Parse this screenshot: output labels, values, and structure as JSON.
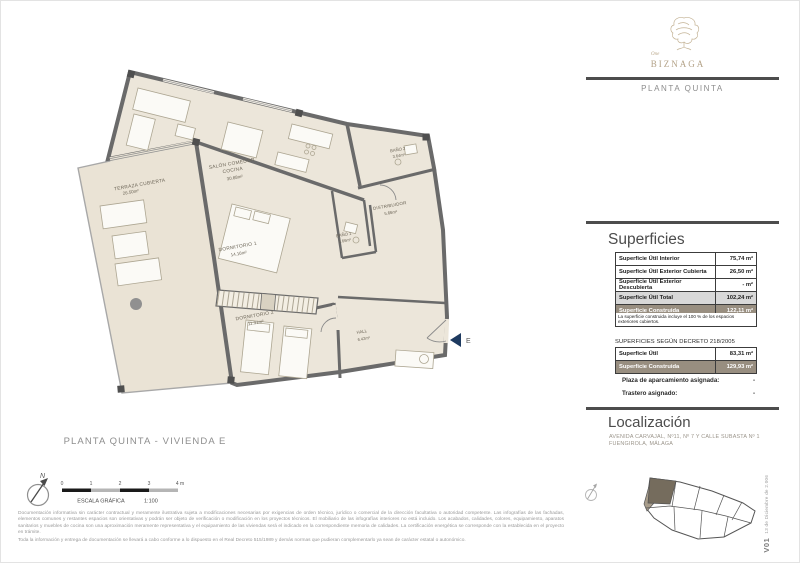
{
  "brand": {
    "word": "One",
    "name": "BIZNAGA",
    "floor": "PLANTA QUINTA"
  },
  "plan": {
    "title": "PLANTA QUINTA - VIVIENDA E",
    "entrance": "E",
    "north": "N",
    "rooms": {
      "terraza": {
        "name": "TERRAZA CUBIERTA",
        "area": "26.50m²"
      },
      "salon": {
        "name1": "SALÓN COMEDOR",
        "name2": "COCINA",
        "area": "30.88m²"
      },
      "dorm1": {
        "name": "DORMITORIO 1",
        "area": "14.16m²"
      },
      "dorm2": {
        "name": "DORMITORIO 2",
        "area": "11.31m²"
      },
      "bano1": {
        "name": "BAÑO 1",
        "area": "3.66m²"
      },
      "bano2": {
        "name": "BAÑO 2",
        "area": "3.64m²"
      },
      "distribuidor": {
        "name": "DISTRIBUIDOR",
        "area": "5.66m²"
      },
      "hall": {
        "name": "HALL",
        "area": "6.42m²"
      }
    },
    "scale": {
      "ticks": [
        "0",
        "1",
        "2",
        "3",
        "4 m"
      ],
      "caption": "ESCALA GRÁFICA",
      "ratio": "1:100"
    }
  },
  "sup": {
    "heading": "Superficies",
    "rows": [
      {
        "label": "Superficie Útil Interior",
        "value": "75,74 m²"
      },
      {
        "label": "Superficie Útil Exterior Cubierta",
        "value": "26,50 m²"
      },
      {
        "label": "Superficie Útil Exterior Descubierta",
        "value": "- m²"
      },
      {
        "label": "Superficie Útil Total",
        "value": "102,24 m²"
      },
      {
        "label": "Superficie Construida",
        "value": "122,11 m²"
      }
    ],
    "note": "La superficie construida incluye el 100 % de los espacios exteriores cubiertos."
  },
  "dec": {
    "title": "SUPERFICIES SEGÚN DECRETO 218/2005",
    "rows": [
      {
        "label": "Superficie Útil",
        "value": "83,31 m²"
      },
      {
        "label": "Superficie Construida",
        "value": "129,93 m²"
      }
    ],
    "extras": [
      {
        "label": "Plaza de aparcamiento asignada:",
        "value": "-"
      },
      {
        "label": "Trastero asignado:",
        "value": "-"
      }
    ]
  },
  "loc": {
    "heading": "Localización",
    "line1": "AVENIDA CARVAJAL, Nº11, Nº 7 Y CALLE SUBASTA Nº 1",
    "line2": "FUENGIROLA, MÁLAGA"
  },
  "footer": {
    "p1": "Documentación informativa sin carácter contractual y meramente ilustrativa sujeta a modificaciones necesarias por exigencias de orden técnico, jurídico o comercial de la dirección facultativa o autoridad competente. Las infografías de las fachadas, elementos comunes y restantes espacios son orientativas y podrán ser objeto de verificación o modificación en los proyectos técnicos. El mobiliario de las infografías interiores no está incluido. Los acabados, calidades, colores, equipamiento, aparatos sanitarios y muebles de cocina son una aproximación meramente representativa y el equipamiento de las viviendas será el indicado en la correspondiente memoria de calidades. La certificación energética se corresponde con la establecida en el proyecto en trámite.",
    "p2": "Toda la información y entrega de documentación se llevará a cabo conforme a lo dispuesto en el Real Decreto 515/1989 y demás normas que pudieran complementarlo ya sean de carácter estatal o autonómico."
  },
  "version": {
    "code": "V01",
    "date": "13 de Diciembre de 2.006"
  },
  "colors": {
    "wall": "#6a6a6a",
    "floor": "#ece6da",
    "terrace_floor": "#eae3d5",
    "accent_taupe": "#988e80",
    "total_gray": "#d8d8d8",
    "brand_beige": "#b3a287",
    "entrance_blue": "#1e3a60",
    "rule_gray": "#4d4d4d"
  }
}
